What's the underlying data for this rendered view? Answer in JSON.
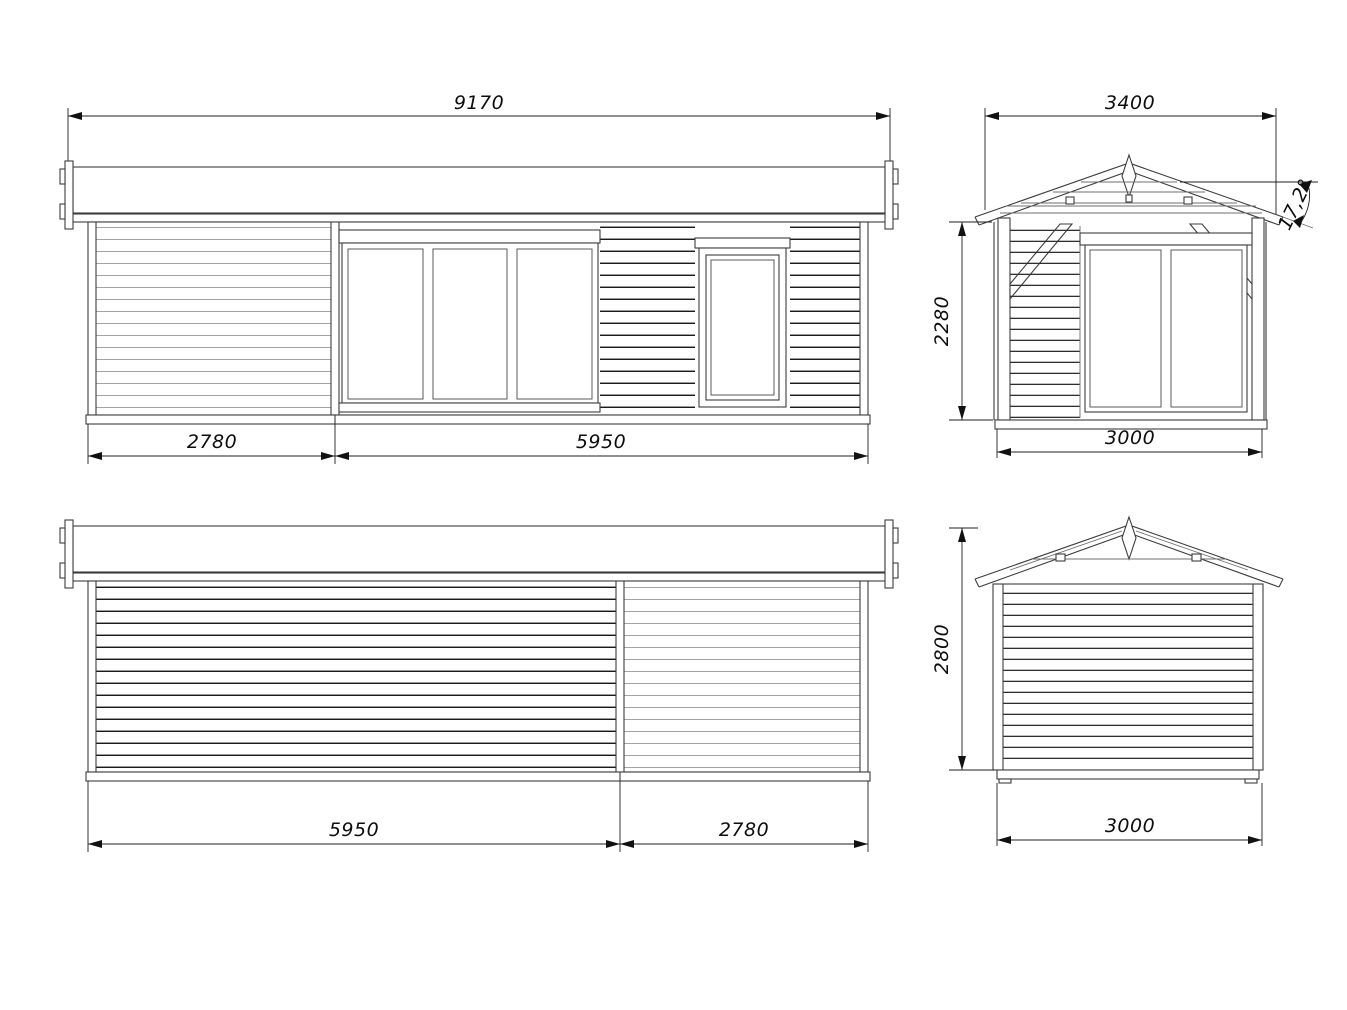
{
  "drawing": {
    "title": "garden-cabin-elevation-drawing",
    "views": {
      "front": {
        "name": "front elevation",
        "total_width": "9170",
        "section_left": "2780",
        "section_right": "5950"
      },
      "side_right": {
        "name": "gable end with porch",
        "roof_width": "3400",
        "roof_angle": "17,2°",
        "wall_height": "2280",
        "base_width": "3000"
      },
      "rear": {
        "name": "rear elevation",
        "section_left": "5950",
        "section_right": "2780"
      },
      "side_left": {
        "name": "gable end rear",
        "total_height": "2800",
        "base_width": "3000"
      }
    },
    "colors": {
      "background": "#ffffff",
      "outline": "#3d3d3d",
      "siding_dark": "#1b1b1b",
      "siding_light": "#a3a3a3",
      "dimension": "#1f1f1f"
    }
  }
}
